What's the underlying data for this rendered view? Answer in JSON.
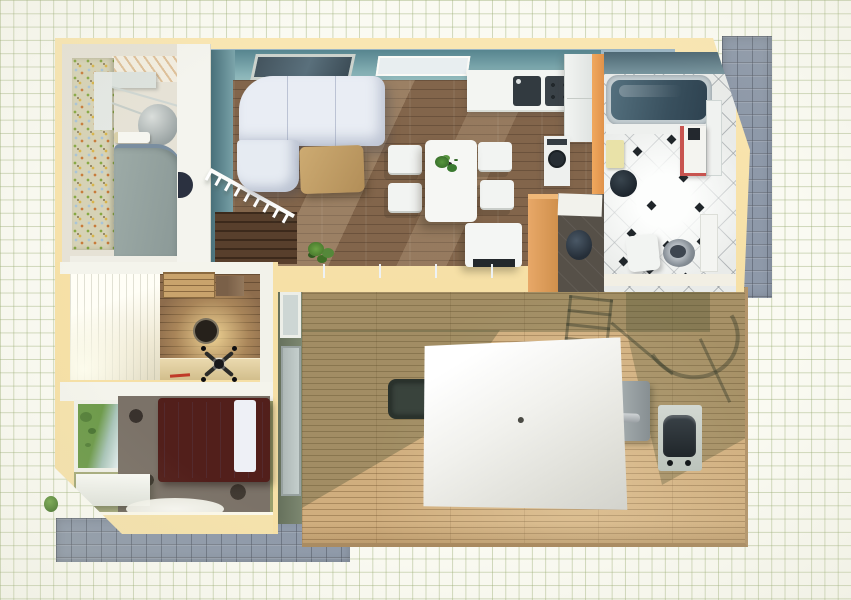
{
  "scene": {
    "title": "Top-down 3D floor plan render on green graph paper",
    "view": "top-down render",
    "paper": {
      "grid_color": "#c6d2ac",
      "background": "#fafaf2"
    }
  },
  "palette": {
    "wall_cream": "#f8e4ae",
    "wall_teal": "#6f9aa4",
    "wall_orange": "#eda55e",
    "wood_floor": "#82654b",
    "deck_wood": "#d0ae7e",
    "paver_stone": "#8e99a9",
    "tile_white": "#e9ebe9",
    "bath_water": "#3d5668",
    "bedroom_floor": "#9aa06c",
    "sofa_white": "#e9edf4",
    "bed_frame": "#521f1b"
  },
  "rooms": {
    "entry": {
      "name": "Entry hall",
      "features": [
        "mosaic accent wall",
        "gray wardrobe",
        "shelf unit",
        "towel bar",
        "rounded chair"
      ]
    },
    "living": {
      "name": "Living room",
      "features": [
        "white corner sofa",
        "wooden coffee table",
        "dining table for four",
        "floor plant",
        "stair railing",
        "skylight window",
        "white bench seat"
      ]
    },
    "kitchen": {
      "name": "Kitchen",
      "features": [
        "counter with sink",
        "cooktop",
        "tall fridge cabinet",
        "oven"
      ]
    },
    "bathroom": {
      "name": "Bathroom",
      "features": [
        "bathtub",
        "vanity sink",
        "toilet",
        "diamond tile floor",
        "plant pot",
        "towel",
        "shower panel"
      ]
    },
    "office": {
      "name": "Home office",
      "features": [
        "desk",
        "round wall lamp",
        "swivel chair",
        "slatted shelf",
        "bright window wall",
        "red pen"
      ]
    },
    "bedroom": {
      "name": "Bedroom",
      "features": [
        "double bed",
        "dotted area rug",
        "garden window",
        "storage bench",
        "oval rug"
      ]
    },
    "deck": {
      "name": "Terrace deck",
      "features": [
        "plank decking",
        "white patio umbrella",
        "umbrella stand",
        "side table",
        "barbecue grill",
        "glass door",
        "chair shadows"
      ]
    }
  },
  "exterior": {
    "features": [
      "stone paver path right",
      "stone paver path bottom",
      "shrub"
    ]
  }
}
